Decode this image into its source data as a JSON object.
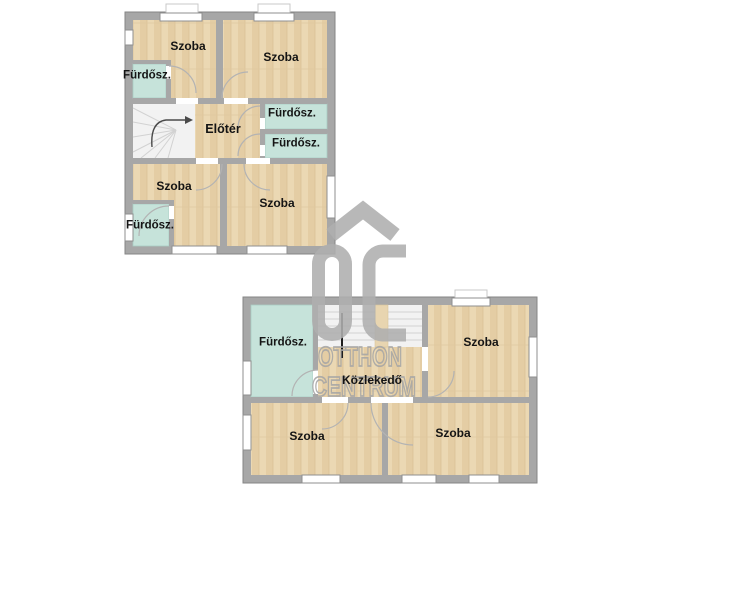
{
  "upper_floor": {
    "labels": {
      "szoba_top_left": "Szoba",
      "szoba_top_right": "Szoba",
      "furdo_left": "Fürdősz.",
      "eloter": "Előtér",
      "furdo_right_1": "Fürdősz.",
      "furdo_right_2": "Fürdősz.",
      "szoba_bottom_left": "Szoba",
      "furdo_bottom_left": "Fürdősz.",
      "szoba_bottom_right": "Szoba"
    }
  },
  "lower_floor": {
    "labels": {
      "furdo": "Fürdősz.",
      "kozlekedo": "Közlekedő",
      "szoba_top_right": "Szoba",
      "szoba_bottom_left": "Szoba",
      "szoba_bottom_right": "Szoba"
    }
  },
  "watermark": {
    "logo": "OC",
    "logo_icon": "roof-chevron-icon",
    "brand_line1": "OTTHON",
    "brand_line2": "CENTRUM"
  },
  "colors": {
    "wall": "#a7a7a7",
    "wood_floor": "#ebd8b3",
    "bathroom": "#c6e3da",
    "watermark_gray": "#afafaf",
    "label_text": "#141414"
  }
}
